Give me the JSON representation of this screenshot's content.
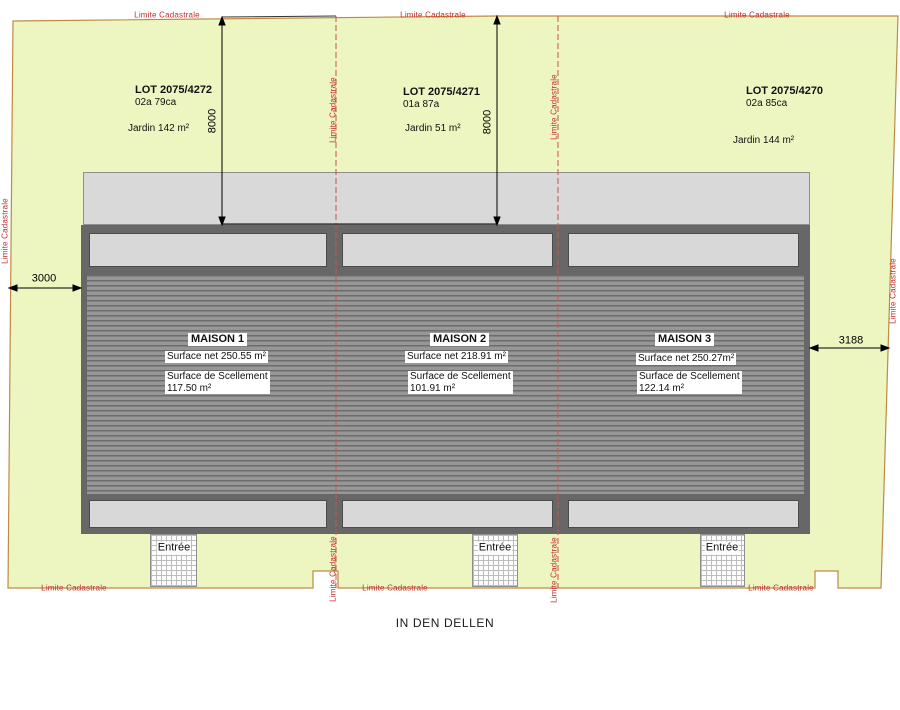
{
  "plan": {
    "street_name": "IN DEN DELLEN",
    "boundary_label": "Limite Cadastrale",
    "lots": [
      {
        "name": "LOT 2075/4272",
        "area": "02a 79ca",
        "garden": "Jardin 142 m²"
      },
      {
        "name": "LOT 2075/4271",
        "area": "01a 87a",
        "garden": "Jardin 51 m²"
      },
      {
        "name": "LOT 2075/4270",
        "area": "02a 85ca",
        "garden": "Jardin 144 m²"
      }
    ],
    "houses": [
      {
        "name": "MAISON 1",
        "surface_net": "Surface net 250.55 m²",
        "surface_sealing": "Surface de Scellement\n117.50 m²"
      },
      {
        "name": "MAISON 2",
        "surface_net": "Surface net 218.91 m²",
        "surface_sealing": "Surface de Scellement\n101.91 m²"
      },
      {
        "name": "MAISON 3",
        "surface_net": "Surface net 250.27m²",
        "surface_sealing": "Surface de Scellement\n122.14 m²"
      }
    ],
    "entrance_label": "Entrée",
    "dimensions": {
      "garden_depth_left": "8000",
      "garden_depth_mid": "8000",
      "left_setback": "3000",
      "right_setback": "3188"
    },
    "colors": {
      "parcel_fill": "#edf6c1",
      "boundary_stroke": "#bf8a45",
      "cadastral_red": "#c32b2b",
      "building_frame": "#676767",
      "building_light": "#d8d8d8"
    }
  }
}
